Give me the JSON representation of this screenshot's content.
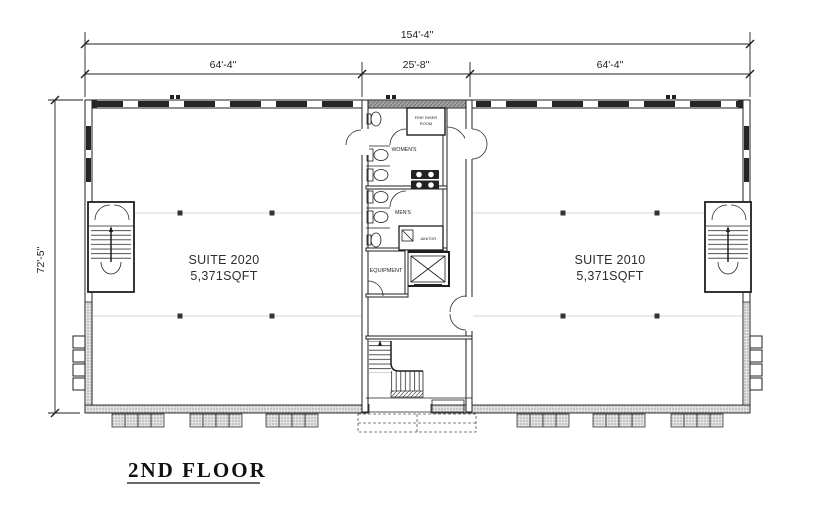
{
  "drawing": {
    "title": "2ND FLOOR"
  },
  "dimensions": {
    "overall": "154'-4\"",
    "segments": [
      "64'-4\"",
      "25'-8\"",
      "64'-4\""
    ],
    "height": "72'-5\""
  },
  "suites": [
    {
      "name": "SUITE 2020",
      "area": "5,371SQFT"
    },
    {
      "name": "SUITE 2010",
      "area": "5,371SQFT"
    }
  ],
  "core": {
    "fire_riser_line1": "FIRE RISER",
    "fire_riser_line2": "ROOM",
    "womens": "WOMEN'S",
    "mens": "MEN'S",
    "janitor": "JANITOR",
    "equipment": "EQUIPMENT"
  },
  "colors": {
    "line": "#1f1f1f",
    "background": "#ffffff",
    "grid": "#c8c8c8",
    "window_fill": "#262626"
  }
}
